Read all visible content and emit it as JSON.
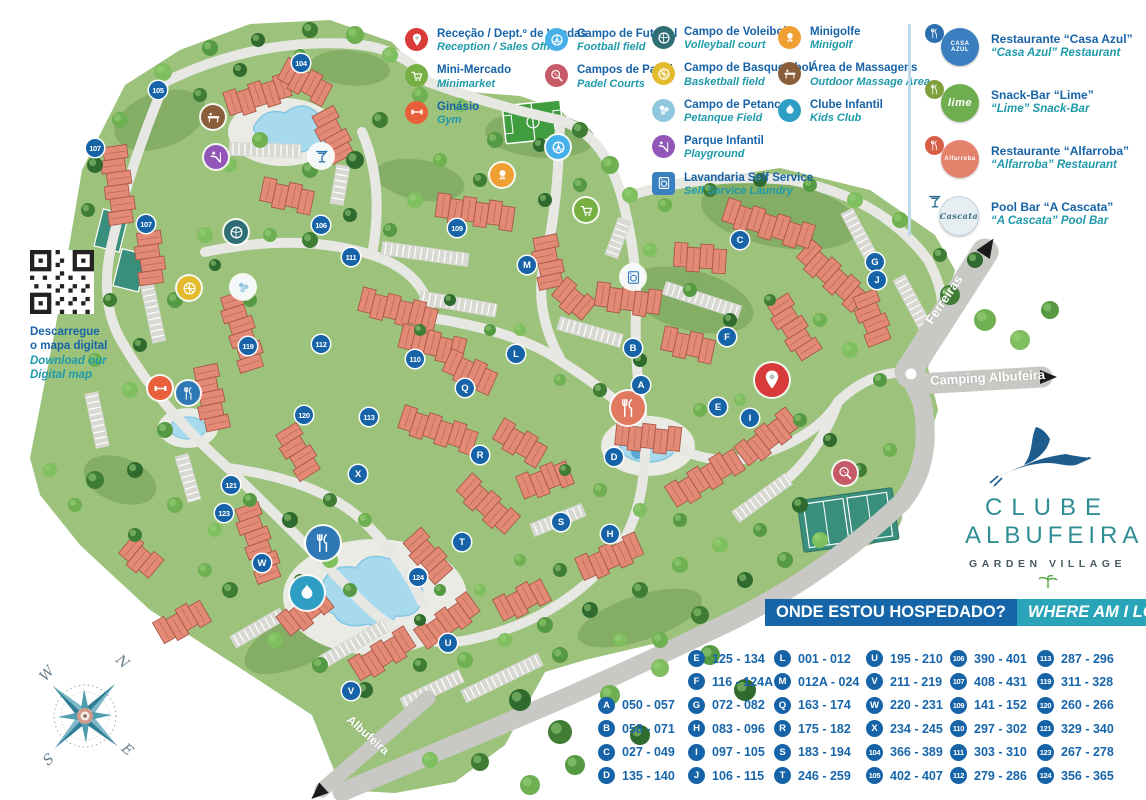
{
  "legend": {
    "columns": [
      {
        "x": 405,
        "y": 28,
        "items": [
          {
            "pt": "Receção / Dept.º de Vendas",
            "en": "Reception / Sales Office",
            "icon": "pin",
            "color": "#d93a3a"
          },
          {
            "pt": "Mini-Mercado",
            "en": "Minimarket",
            "icon": "cart",
            "color": "#76b043"
          },
          {
            "pt": "Ginásio",
            "en": "Gym",
            "icon": "dumbbell",
            "color": "#e85f3c"
          }
        ]
      },
      {
        "x": 545,
        "y": 28,
        "items": [
          {
            "pt": "Campo de Futebol",
            "en": "Football field",
            "icon": "football",
            "color": "#45b1e8"
          },
          {
            "pt": "Campos de Padel",
            "en": "Padel Courts",
            "icon": "padel",
            "color": "#c75a68"
          }
        ]
      },
      {
        "x": 652,
        "y": 26,
        "items": [
          {
            "pt": "Campo de Voleibol",
            "en": "Volleyball court",
            "icon": "volleyball",
            "color": "#2f6e74"
          },
          {
            "pt": "Campo de Basquetebol",
            "en": "Basketball field",
            "icon": "basketball",
            "color": "#e3bb2f"
          },
          {
            "pt": "Campo de Petanca",
            "en": "Petanque Field",
            "icon": "petanque",
            "color": "#8fc8de"
          },
          {
            "pt": "Parque Infantil",
            "en": "Playground",
            "icon": "slide",
            "color": "#9156b8"
          },
          {
            "pt": "Lavandaria Self Service",
            "en": "Self Service Laundry",
            "icon": "washer",
            "color": "#3a7fc0",
            "square": true
          }
        ]
      },
      {
        "x": 778,
        "y": 26,
        "items": [
          {
            "pt": "Minigolfe",
            "en": "Minigolf",
            "icon": "golf",
            "color": "#f0a033"
          },
          {
            "pt": "Área de Massagens",
            "en": "Outdoor Massage Area",
            "icon": "massage",
            "color": "#8a5e3a"
          },
          {
            "pt": "Clube Infantil",
            "en": "Kids Club",
            "icon": "splash",
            "color": "#2e9ec4"
          }
        ]
      }
    ]
  },
  "restaurants": {
    "items": [
      {
        "pt": "Restaurante “Casa Azul”",
        "en": "“Casa Azul” Restaurant",
        "main": "#3c7fc0",
        "badge": "#2d6fae",
        "logo_text": "CASA AZUL",
        "badge_icon": "forkknife"
      },
      {
        "pt": "Snack-Bar “Lime”",
        "en": "“Lime” Snack-Bar",
        "main": "#6fae4e",
        "badge": "#7fa03c",
        "logo_text": "lime",
        "badge_icon": "forkknife"
      },
      {
        "pt": "Restaurante “Alfarroba”",
        "en": "“Alfarroba” Restaurant",
        "main": "#e4816b",
        "badge": "#d65f48",
        "logo_text": "Alfarroba",
        "badge_icon": "forkknife"
      },
      {
        "pt": "Pool Bar “A Cascata”",
        "en": "“A Cascata” Pool Bar",
        "main": "#e7eef1",
        "badge": "",
        "logo_text": "Cascata",
        "badge_icon": "cocktail",
        "light": true
      }
    ]
  },
  "qr": {
    "pt1": "Descarregue",
    "pt2": "o mapa digital",
    "en1": "Download our",
    "en2": "Digital map"
  },
  "banner": {
    "pt": "ONDE ESTOU HOSPEDADO?",
    "en": "WHERE AM I LOCATED?"
  },
  "index": {
    "columns": [
      {
        "x": 598,
        "start_row": 2,
        "rows": [
          {
            "b": "A",
            "r": "050 - 057"
          },
          {
            "b": "B",
            "r": "058 - 071"
          },
          {
            "b": "C",
            "r": "027 - 049"
          },
          {
            "b": "D",
            "r": "135 - 140"
          }
        ]
      },
      {
        "x": 688,
        "start_row": 0,
        "rows": [
          {
            "b": "E",
            "r": "125 - 134"
          },
          {
            "b": "F",
            "r": "116 - 124A"
          },
          {
            "b": "G",
            "r": "072 - 082"
          },
          {
            "b": "H",
            "r": "083 - 096"
          },
          {
            "b": "I",
            "r": "097 - 105"
          },
          {
            "b": "J",
            "r": "106 - 115"
          }
        ]
      },
      {
        "x": 774,
        "start_row": 0,
        "rows": [
          {
            "b": "L",
            "r": "001 - 012"
          },
          {
            "b": "M",
            "r": "012A - 024"
          },
          {
            "b": "Q",
            "r": "163 - 174"
          },
          {
            "b": "R",
            "r": "175 - 182"
          },
          {
            "b": "S",
            "r": "183 - 194"
          },
          {
            "b": "T",
            "r": "246 - 259"
          }
        ]
      },
      {
        "x": 866,
        "start_row": 0,
        "rows": [
          {
            "b": "U",
            "r": "195 - 210"
          },
          {
            "b": "V",
            "r": "211 - 219"
          },
          {
            "b": "W",
            "r": "220 - 231"
          },
          {
            "b": "X",
            "r": "234 - 245"
          },
          {
            "b": "104",
            "r": "366 - 389"
          },
          {
            "b": "105",
            "r": "402 - 407"
          }
        ]
      },
      {
        "x": 950,
        "start_row": 0,
        "rows": [
          {
            "b": "106",
            "r": "390 - 401"
          },
          {
            "b": "107",
            "r": "408 - 431"
          },
          {
            "b": "109",
            "r": "141 - 152"
          },
          {
            "b": "110",
            "r": "297 - 302"
          },
          {
            "b": "111",
            "r": "303 - 310"
          },
          {
            "b": "112",
            "r": "279 - 286"
          }
        ]
      },
      {
        "x": 1037,
        "start_row": 0,
        "rows": [
          {
            "b": "113",
            "r": "287 - 296"
          },
          {
            "b": "119",
            "r": "311 - 328"
          },
          {
            "b": "120",
            "r": "260 - 266"
          },
          {
            "b": "121",
            "r": "329 - 340"
          },
          {
            "b": "123",
            "r": "267 - 278"
          },
          {
            "b": "124",
            "r": "356 - 365"
          }
        ]
      }
    ]
  },
  "map": {
    "roads": {
      "ferreiras": "Ferreiras",
      "camping": "Camping Albufeira",
      "albufeira": "Albufeira"
    },
    "markers": [
      {
        "label": "104",
        "x": 301,
        "y": 63
      },
      {
        "label": "105",
        "x": 158,
        "y": 90
      },
      {
        "label": "107",
        "x": 95,
        "y": 148
      },
      {
        "label": "107",
        "x": 146,
        "y": 224
      },
      {
        "label": "106",
        "x": 321,
        "y": 225
      },
      {
        "label": "109",
        "x": 457,
        "y": 228
      },
      {
        "label": "111",
        "x": 351,
        "y": 257
      },
      {
        "label": "M",
        "x": 527,
        "y": 265
      },
      {
        "label": "C",
        "x": 740,
        "y": 240
      },
      {
        "label": "G",
        "x": 875,
        "y": 262
      },
      {
        "label": "J",
        "x": 877,
        "y": 280
      },
      {
        "label": "119",
        "x": 248,
        "y": 346
      },
      {
        "label": "112",
        "x": 321,
        "y": 344
      },
      {
        "label": "110",
        "x": 415,
        "y": 359
      },
      {
        "label": "L",
        "x": 516,
        "y": 354
      },
      {
        "label": "B",
        "x": 633,
        "y": 348
      },
      {
        "label": "F",
        "x": 727,
        "y": 337
      },
      {
        "label": "Q",
        "x": 465,
        "y": 388
      },
      {
        "label": "A",
        "x": 641,
        "y": 385
      },
      {
        "label": "E",
        "x": 718,
        "y": 407
      },
      {
        "label": "I",
        "x": 750,
        "y": 418
      },
      {
        "label": "113",
        "x": 369,
        "y": 417
      },
      {
        "label": "120",
        "x": 304,
        "y": 415
      },
      {
        "label": "D",
        "x": 614,
        "y": 457
      },
      {
        "label": "R",
        "x": 480,
        "y": 455
      },
      {
        "label": "X",
        "x": 358,
        "y": 474
      },
      {
        "label": "121",
        "x": 231,
        "y": 485
      },
      {
        "label": "123",
        "x": 224,
        "y": 513
      },
      {
        "label": "S",
        "x": 561,
        "y": 522
      },
      {
        "label": "H",
        "x": 610,
        "y": 534
      },
      {
        "label": "T",
        "x": 462,
        "y": 542
      },
      {
        "label": "W",
        "x": 262,
        "y": 563
      },
      {
        "label": "124",
        "x": 418,
        "y": 577
      },
      {
        "label": "U",
        "x": 448,
        "y": 643
      },
      {
        "label": "V",
        "x": 351,
        "y": 691
      }
    ],
    "amenities": [
      {
        "name": "massage-area-icon",
        "glyph": "massage",
        "x": 213,
        "y": 117,
        "color": "#8a5e3a"
      },
      {
        "name": "playground-icon",
        "glyph": "slide",
        "x": 216,
        "y": 157,
        "color": "#9156b8"
      },
      {
        "name": "football-field-icon",
        "glyph": "football",
        "x": 558,
        "y": 147,
        "color": "#45b1e8"
      },
      {
        "name": "minigolf-icon",
        "glyph": "golf",
        "x": 502,
        "y": 175,
        "color": "#f0a033"
      },
      {
        "name": "minimarket-icon",
        "glyph": "cart",
        "x": 586,
        "y": 210,
        "color": "#76b043"
      },
      {
        "name": "laundry-icon",
        "glyph": "washer",
        "x": 633,
        "y": 277,
        "color": "#3a7fc0",
        "light": true
      },
      {
        "name": "volleyball-icon",
        "glyph": "volleyball",
        "x": 236,
        "y": 232,
        "color": "#2f6e74"
      },
      {
        "name": "basketball-icon",
        "glyph": "basketball",
        "x": 189,
        "y": 288,
        "color": "#e3bb2f"
      },
      {
        "name": "petanque-icon",
        "glyph": "petanque",
        "x": 243,
        "y": 287,
        "color": "#8fc8de",
        "light": true
      },
      {
        "name": "gym-icon",
        "glyph": "dumbbell",
        "x": 160,
        "y": 388,
        "color": "#e85f3c"
      },
      {
        "name": "restaurant-icon",
        "glyph": "forkknife",
        "x": 188,
        "y": 393,
        "color": "#2e78b5"
      },
      {
        "name": "pool-bar-icon",
        "glyph": "cocktail",
        "x": 321,
        "y": 156,
        "color": "#f2f6f7",
        "light": true
      },
      {
        "name": "restaurant-alfarroba-icon",
        "glyph": "forkknife",
        "x": 628,
        "y": 408,
        "color": "#e0795f",
        "big": true
      },
      {
        "name": "snack-bar-icon",
        "glyph": "forkknife",
        "x": 323,
        "y": 543,
        "color": "#2e78b5",
        "big": true
      },
      {
        "name": "kids-club-icon",
        "glyph": "splash",
        "x": 307,
        "y": 593,
        "color": "#2e9ec4",
        "big": true
      },
      {
        "name": "padel-courts-icon",
        "glyph": "padel",
        "x": 845,
        "y": 473,
        "color": "#c75a68"
      },
      {
        "name": "reception-pin-icon",
        "glyph": "pin",
        "x": 772,
        "y": 380,
        "color": "#d93a3a",
        "big": true
      }
    ]
  },
  "brand": {
    "line1": "CLUBE",
    "line2": "ALBUFEIRA",
    "line3": "GARDEN VILLAGE"
  },
  "compass": {
    "n": "N",
    "s": "S",
    "e": "E",
    "w": "W"
  },
  "colors": {
    "marker_blue": "#1763a8",
    "text_blue": "#1763a8",
    "text_teal": "#1f9aab",
    "banner_blue": "#1565a8",
    "banner_teal": "#2aa4b8",
    "terrain": "#9cc27c",
    "terrain_dark": "#7ca55d",
    "road_main": "#c8c8c4",
    "road_minor": "#e7e7e3",
    "building": "#e28a76",
    "building_line": "#aa5848",
    "pool": "#a8daee",
    "court": "#3a8f7c"
  }
}
